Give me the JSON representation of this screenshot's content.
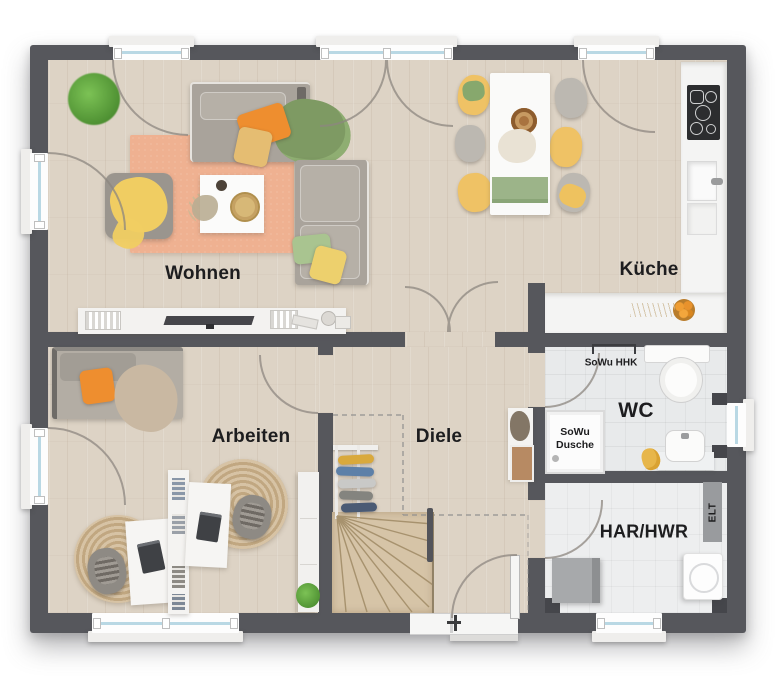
{
  "type": "floor-plan",
  "rooms": {
    "wohnen": {
      "label": "Wohnen"
    },
    "kueche": {
      "label": "Küche"
    },
    "arbeiten": {
      "label": "Arbeiten"
    },
    "diele": {
      "label": "Diele"
    },
    "wc": {
      "label": "WC"
    },
    "har_hwr": {
      "label": "HAR/HWR"
    }
  },
  "annotations": {
    "sowu_hhk": "SoWu HHK",
    "sowu_dusche": {
      "line1": "SoWu",
      "line2": "Dusche"
    },
    "elt": "ELT"
  },
  "colors": {
    "wall": "#56575c",
    "wood_floor": "#ddd3c5",
    "tile_floor": "#e8eaeb",
    "tile_floor_light": "#edeeef",
    "rug_peach": "#efb191",
    "stair_wood": "#d6c4a7",
    "accent_orange": "#ee8e2f",
    "accent_yellow": "#efc265",
    "accent_green": "#7e9a63",
    "window_glass": "#b9d8e4",
    "label_text": "#1d1d1f"
  }
}
